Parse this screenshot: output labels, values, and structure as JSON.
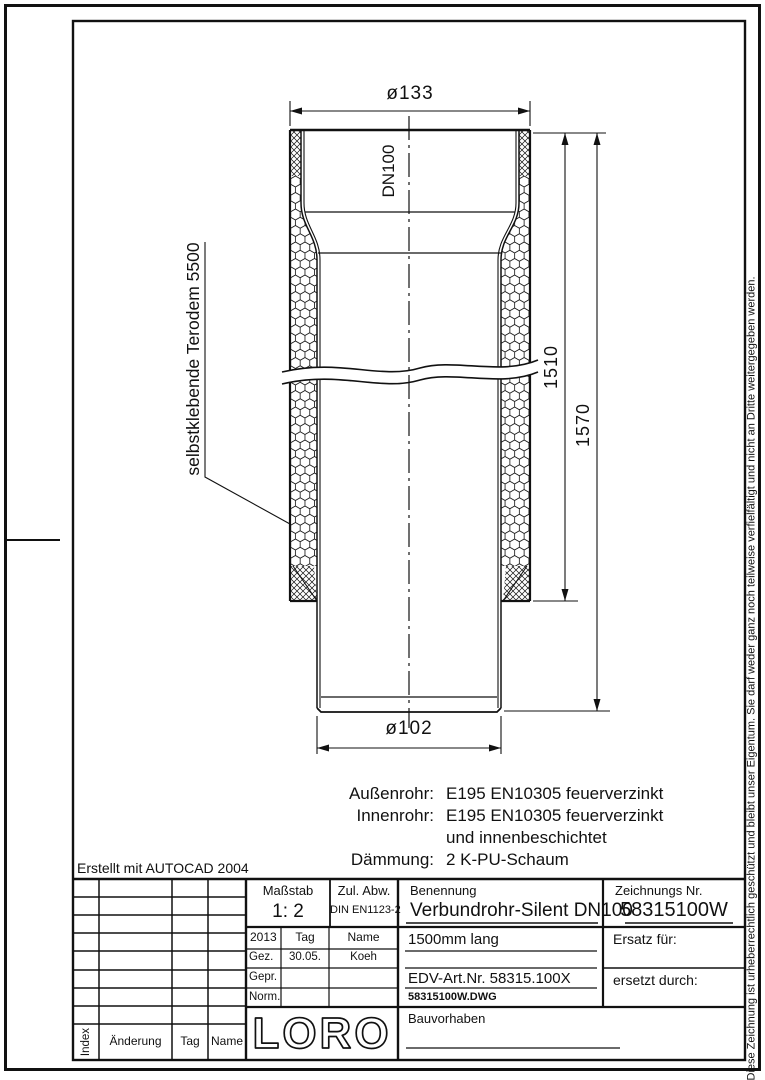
{
  "drawing": {
    "dim_top_diameter": "ø133",
    "dim_bottom_diameter": "ø102",
    "dim_insulated_length": "1510",
    "dim_total_length": "1570",
    "pipe_size_label": "DN100",
    "insulation_note": "selbstklebende Terodem 5500",
    "materials": {
      "rows": [
        {
          "label": "Außenrohr:",
          "value": "E195 EN10305 feuerverzinkt"
        },
        {
          "label": "Innenrohr:",
          "value": "E195 EN10305 feuerverzinkt"
        },
        {
          "label": "",
          "value": "und innenbeschichtet"
        },
        {
          "label": "Dämmung:",
          "value": "2 K-PU-Schaum"
        }
      ]
    },
    "created_note": "Erstellt mit AUTOCAD 2004"
  },
  "title_block": {
    "scale_label": "Maßstab",
    "scale_value": "1: 2",
    "tolerance_label": "Zul. Abw.",
    "tolerance_value": "DIN EN1123-2",
    "name_label": "Benennung",
    "name_value": "Verbundrohr-Silent DN100",
    "drawing_no_label": "Zeichnungs Nr.",
    "drawing_no_value": "58315100W",
    "length_note": "1500mm lang",
    "edv_art_no": "EDV-Art.Nr. 58315.100X",
    "file_name": "58315100W.DWG",
    "replacement_for_label": "Ersatz für:",
    "replaced_by_label": "ersetzt durch:",
    "project_label": "Bauvorhaben",
    "logo_text": "LORO",
    "approval": {
      "year": "2013",
      "col_tag": "Tag",
      "col_name": "Name",
      "rows": [
        {
          "label": "Gez.",
          "tag": "30.05.",
          "name": "Koeh"
        },
        {
          "label": "Gepr.",
          "tag": "",
          "name": ""
        },
        {
          "label": "Norm.",
          "tag": "",
          "name": ""
        }
      ]
    },
    "revision_header": {
      "index": "Index",
      "change": "Änderung",
      "tag": "Tag",
      "name": "Name"
    }
  },
  "copyright_note": "Diese Zeichnung ist urheberrechtlich geschützt und bleibt unser Eigentum. Sie darf weder ganz noch teilweise verfielfältigt und nicht an Dritte weitergegeben werden."
}
